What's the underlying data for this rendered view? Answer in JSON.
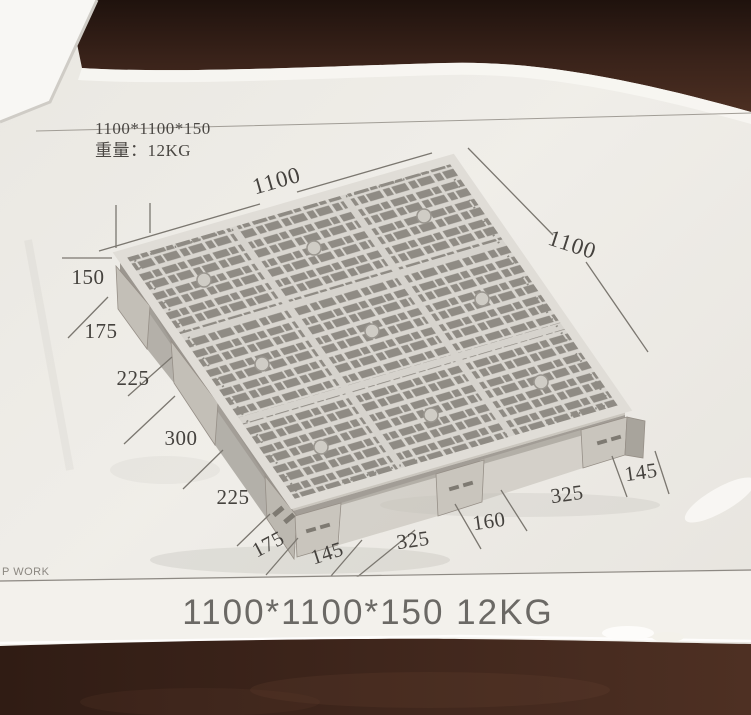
{
  "photo": {
    "spec": {
      "line1": "1100*1100*150",
      "line2": "重量：12KG"
    },
    "caption": "1100*1100*150  12KG",
    "watermark": "P WORK"
  },
  "dimensions": {
    "top_edge": "1100",
    "right_edge": "1100",
    "height": "150",
    "left_spacings": [
      "175",
      "225",
      "300",
      "225",
      "175"
    ],
    "foot_left": "145",
    "bottom_spacings": [
      "325",
      "160",
      "325"
    ],
    "foot_right": "145"
  },
  "colors": {
    "wood_dark": "#2c1a13",
    "wood_mid": "#4a2d21",
    "paper": "#edebe6",
    "paper_bright": "#f7f6f2",
    "pallet_light": "#d9d6d0",
    "pallet_hole": "#8f8b84",
    "pallet_side": "#b3afa7",
    "pallet_leg": "#c3bfb7",
    "dim_line": "#7b7770",
    "dim_text": "#45423e",
    "caption_text": "#6b6965"
  }
}
